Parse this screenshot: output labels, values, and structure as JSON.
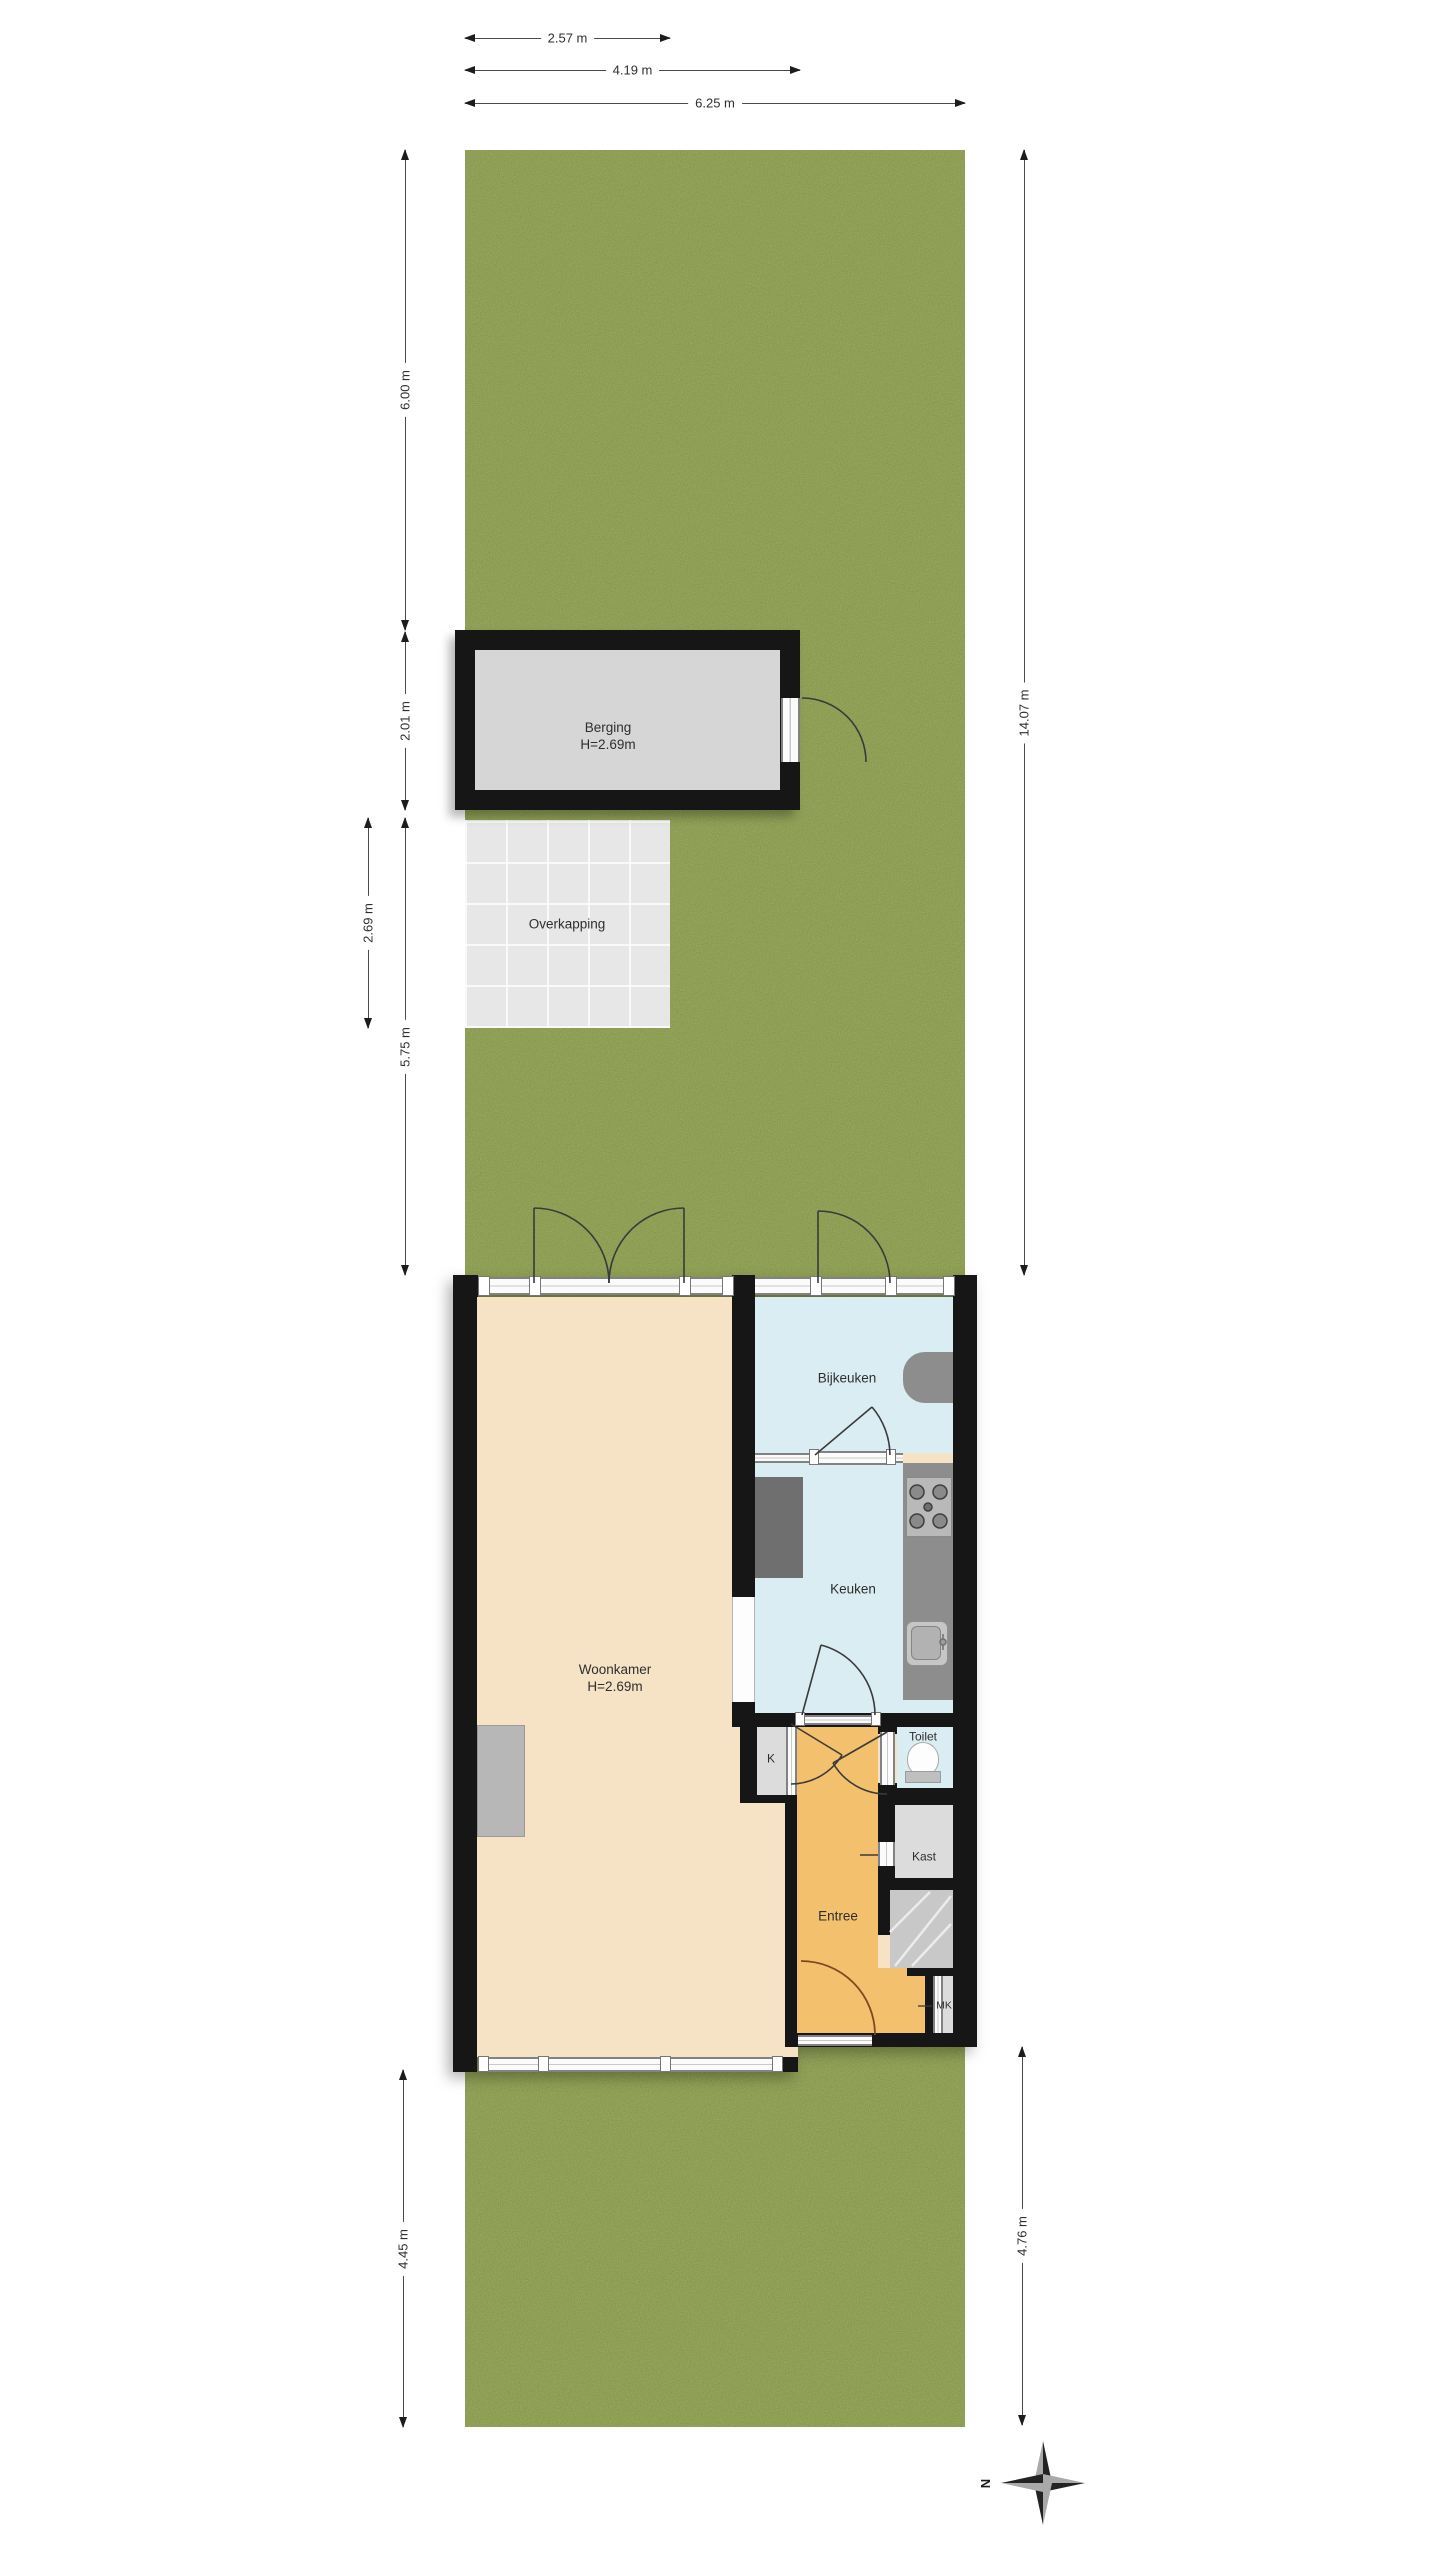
{
  "plan": {
    "type": "floor-plan-with-garden",
    "language": "nl"
  },
  "dimensions": {
    "top": [
      {
        "label": "2.57 m"
      },
      {
        "label": "4.19 m"
      },
      {
        "label": "6.25 m"
      }
    ],
    "left": [
      {
        "label": "6.00 m"
      },
      {
        "label": "2.01 m"
      },
      {
        "label": "2.69 m"
      },
      {
        "label": "5.75 m"
      },
      {
        "label": "4.45 m"
      }
    ],
    "right": [
      {
        "label": "14.07 m"
      },
      {
        "label": "4.76 m"
      }
    ]
  },
  "rooms": {
    "berging": {
      "name": "Berging",
      "height": "H=2.69m"
    },
    "overkapping": {
      "name": "Overkapping"
    },
    "woonkamer": {
      "name": "Woonkamer",
      "height": "H=2.69m"
    },
    "bijkeuken": {
      "name": "Bijkeuken"
    },
    "keuken": {
      "name": "Keuken"
    },
    "toilet": {
      "name": "Toilet"
    },
    "kast": {
      "name": "Kast"
    },
    "entree": {
      "name": "Entree"
    },
    "k_closet": {
      "name": "K"
    },
    "meterkast": {
      "name": "MK"
    }
  },
  "compass": {
    "north_label": "N"
  },
  "colors": {
    "grass": "#7e9146",
    "wall": "#161616",
    "floor-living": "#f6e3c5",
    "floor-wet": "#daedf2",
    "floor-hall": "#f3c06d",
    "floor-closet": "#dcdcdc",
    "counter": "#8d8d8d",
    "appliance": "#6f6f6f",
    "stairs": "#c8c8c8",
    "dim-text": "#2f2f2f"
  }
}
